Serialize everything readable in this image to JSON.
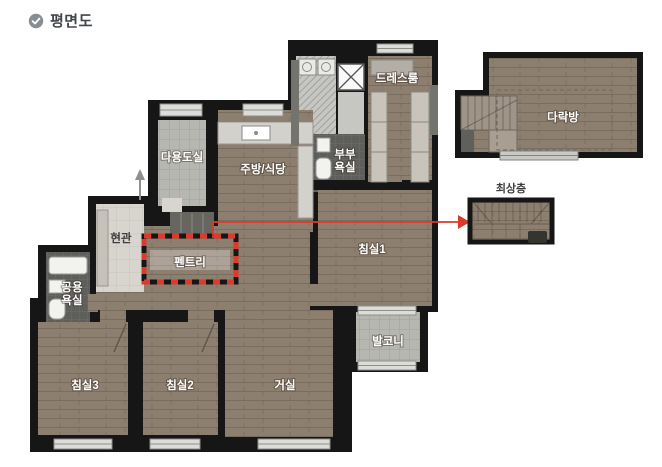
{
  "header": {
    "title": "평면도",
    "icon": "check-circle-icon"
  },
  "plan": {
    "rooms": {
      "dressroom": {
        "label": "드레스룸"
      },
      "utility": {
        "label": "다용도실"
      },
      "kitchen": {
        "label": "주방/식당"
      },
      "master_bath": {
        "line1": "부부",
        "line2": "욕실"
      },
      "entrance": {
        "label": "현관"
      },
      "pantry": {
        "label": "펜트리"
      },
      "bedroom1": {
        "label": "침실1"
      },
      "shared_bath": {
        "line1": "공용",
        "line2": "욕실"
      },
      "bedroom3": {
        "label": "침실3"
      },
      "bedroom2": {
        "label": "침실2"
      },
      "living": {
        "label": "거실"
      },
      "balcony": {
        "label": "발코니"
      }
    },
    "annex": {
      "attic": {
        "label": "다락방"
      },
      "top_floor": {
        "label": "최상층"
      }
    },
    "colors": {
      "wall": "#161616",
      "wood_floor": "#8d7f70",
      "highlight_red": "#dd3a2b",
      "tile_light": "#b7b7b1",
      "tile_dark": "#5e5e5a",
      "title_text": "#41464b"
    }
  }
}
